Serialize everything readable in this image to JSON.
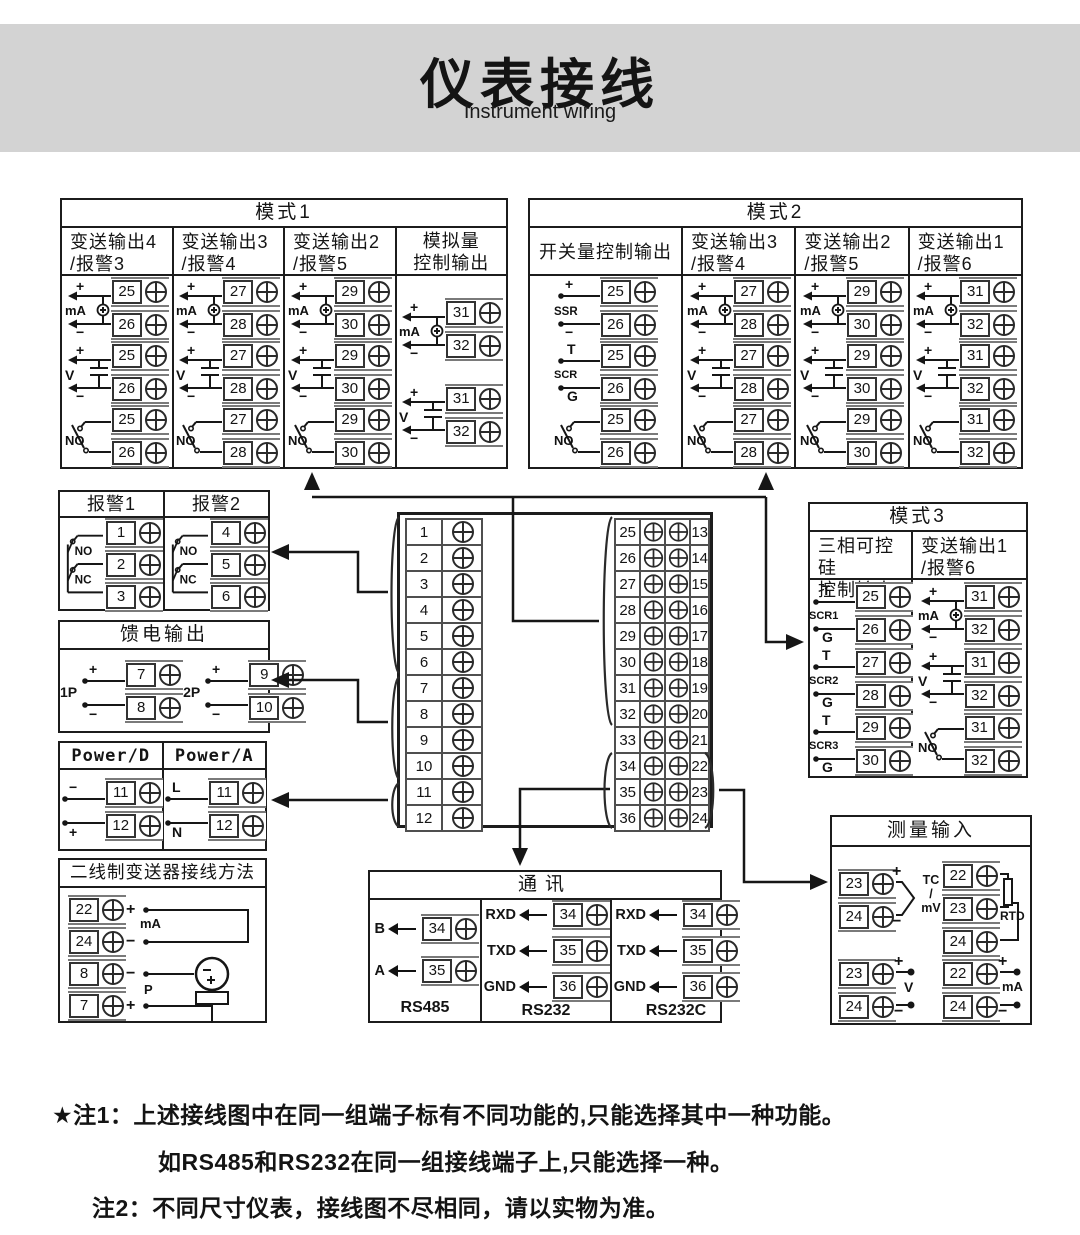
{
  "title": {
    "zh": "仪表接线",
    "en": "Instrument wiring"
  },
  "modes": {
    "mode1": {
      "title": "模式1",
      "columns": [
        {
          "header": "变送输出4\n/报警3",
          "diagrams": [
            {
              "type": "ma",
              "label": "mA",
              "top": "+",
              "bottom": "−",
              "terminals": [
                "25",
                "26"
              ]
            },
            {
              "type": "v",
              "label": "V",
              "top": "+",
              "bottom": "−",
              "terminals": [
                "25",
                "26"
              ]
            },
            {
              "type": "no",
              "label": "NO",
              "terminals": [
                "25",
                "26"
              ]
            }
          ]
        },
        {
          "header": "变送输出3\n/报警4",
          "diagrams": [
            {
              "type": "ma",
              "label": "mA",
              "top": "+",
              "bottom": "−",
              "terminals": [
                "27",
                "28"
              ]
            },
            {
              "type": "v",
              "label": "V",
              "top": "+",
              "bottom": "−",
              "terminals": [
                "27",
                "28"
              ]
            },
            {
              "type": "no",
              "label": "NO",
              "terminals": [
                "27",
                "28"
              ]
            }
          ]
        },
        {
          "header": "变送输出2\n/报警5",
          "diagrams": [
            {
              "type": "ma",
              "label": "mA",
              "top": "+",
              "bottom": "−",
              "terminals": [
                "29",
                "30"
              ]
            },
            {
              "type": "v",
              "label": "V",
              "top": "+",
              "bottom": "−",
              "terminals": [
                "29",
                "30"
              ]
            },
            {
              "type": "no",
              "label": "NO",
              "terminals": [
                "29",
                "30"
              ]
            }
          ]
        },
        {
          "header": "模拟量\n控制输出",
          "diagrams": [
            {
              "type": "ma",
              "label": "mA",
              "top": "+",
              "bottom": "−",
              "terminals": [
                "31",
                "32"
              ]
            },
            {
              "type": "v",
              "label": "V",
              "top": "+",
              "bottom": "−",
              "terminals": [
                "31",
                "32"
              ]
            }
          ]
        }
      ]
    },
    "mode2": {
      "title": "模式2",
      "columns": [
        {
          "header": "开关量控制输出",
          "diagrams": [
            {
              "type": "ssr",
              "label": "SSR",
              "top": "+",
              "bottom": "−",
              "terminals": [
                "25",
                "26"
              ]
            },
            {
              "type": "scr",
              "label": "SCR",
              "top": "T",
              "bottom": "G",
              "terminals": [
                "25",
                "26"
              ]
            },
            {
              "type": "no",
              "label": "NO",
              "terminals": [
                "25",
                "26"
              ]
            }
          ]
        },
        {
          "header": "变送输出3\n/报警4",
          "diagrams": [
            {
              "type": "ma",
              "label": "mA",
              "top": "+",
              "bottom": "−",
              "terminals": [
                "27",
                "28"
              ]
            },
            {
              "type": "v",
              "label": "V",
              "top": "+",
              "bottom": "−",
              "terminals": [
                "27",
                "28"
              ]
            },
            {
              "type": "no",
              "label": "NO",
              "terminals": [
                "27",
                "28"
              ]
            }
          ]
        },
        {
          "header": "变送输出2\n/报警5",
          "diagrams": [
            {
              "type": "ma",
              "label": "mA",
              "top": "+",
              "bottom": "−",
              "terminals": [
                "29",
                "30"
              ]
            },
            {
              "type": "v",
              "label": "V",
              "top": "+",
              "bottom": "−",
              "terminals": [
                "29",
                "30"
              ]
            },
            {
              "type": "no",
              "label": "NO",
              "terminals": [
                "29",
                "30"
              ]
            }
          ]
        },
        {
          "header": "变送输出1\n/报警6",
          "diagrams": [
            {
              "type": "ma",
              "label": "mA",
              "top": "+",
              "bottom": "−",
              "terminals": [
                "31",
                "32"
              ]
            },
            {
              "type": "v",
              "label": "V",
              "top": "+",
              "bottom": "−",
              "terminals": [
                "31",
                "32"
              ]
            },
            {
              "type": "no",
              "label": "NO",
              "terminals": [
                "31",
                "32"
              ]
            }
          ]
        }
      ]
    },
    "mode3": {
      "title": "模式3",
      "columns": [
        {
          "header": "三相可控硅\n控制输出",
          "diagrams": [
            {
              "type": "scr",
              "label": "SCR1",
              "top": "T",
              "bottom": "G",
              "terminals": [
                "25",
                "26"
              ]
            },
            {
              "type": "scr",
              "label": "SCR2",
              "top": "T",
              "bottom": "G",
              "terminals": [
                "27",
                "28"
              ]
            },
            {
              "type": "scr",
              "label": "SCR3",
              "top": "T",
              "bottom": "G",
              "terminals": [
                "29",
                "30"
              ]
            }
          ]
        },
        {
          "header": "变送输出1\n/报警6",
          "diagrams": [
            {
              "type": "ma",
              "label": "mA",
              "top": "+",
              "bottom": "−",
              "terminals": [
                "31",
                "32"
              ]
            },
            {
              "type": "v",
              "label": "V",
              "top": "+",
              "bottom": "−",
              "terminals": [
                "31",
                "32"
              ]
            },
            {
              "type": "no",
              "label": "NO",
              "terminals": [
                "31",
                "32"
              ]
            }
          ]
        }
      ]
    }
  },
  "alarm": {
    "columns": [
      {
        "header": "报警1",
        "no": "NO",
        "nc": "NC",
        "terminals": [
          "1",
          "2",
          "3"
        ]
      },
      {
        "header": "报警2",
        "no": "NO",
        "nc": "NC",
        "terminals": [
          "4",
          "5",
          "6"
        ]
      }
    ]
  },
  "feed": {
    "title": "馈电输出",
    "groups": [
      {
        "label": "1P",
        "top": "+",
        "bottom": "−",
        "terminals": [
          "7",
          "8"
        ]
      },
      {
        "label": "2P",
        "top": "+",
        "bottom": "−",
        "terminals": [
          "9",
          "10"
        ]
      }
    ]
  },
  "power": {
    "columns": [
      {
        "header": "Power/D",
        "top": "−",
        "bottom": "+",
        "terminals": [
          "11",
          "12"
        ]
      },
      {
        "header": "Power/A",
        "top": "L",
        "bottom": "N",
        "terminals": [
          "11",
          "12"
        ]
      }
    ]
  },
  "twowire": {
    "title": "二线制变送器接线方法",
    "ma_label": "mA",
    "p_label": "P",
    "rows": [
      {
        "terminal": "22",
        "sign": "+"
      },
      {
        "terminal": "24",
        "sign": "−"
      },
      {
        "terminal": "8",
        "sign": "−"
      },
      {
        "terminal": "7",
        "sign": "+"
      }
    ]
  },
  "center": {
    "left": [
      "1",
      "2",
      "3",
      "4",
      "5",
      "6",
      "7",
      "8",
      "9",
      "10",
      "11",
      "12"
    ],
    "rows": [
      [
        "25",
        "13"
      ],
      [
        "26",
        "14"
      ],
      [
        "27",
        "15"
      ],
      [
        "28",
        "16"
      ],
      [
        "29",
        "17"
      ],
      [
        "30",
        "18"
      ],
      [
        "31",
        "19"
      ],
      [
        "32",
        "20"
      ],
      [
        "33",
        "21"
      ],
      [
        "34",
        "22"
      ],
      [
        "35",
        "23"
      ],
      [
        "36",
        "24"
      ]
    ]
  },
  "comm": {
    "title": "通讯",
    "sections": [
      {
        "name": "RS485",
        "rows": [
          {
            "label": "B",
            "terminal": "34"
          },
          {
            "label": "A",
            "terminal": "35"
          }
        ]
      },
      {
        "name": "RS232",
        "rows": [
          {
            "label": "RXD",
            "terminal": "34"
          },
          {
            "label": "TXD",
            "terminal": "35"
          },
          {
            "label": "GND",
            "terminal": "36"
          }
        ]
      },
      {
        "name": "RS232C",
        "rows": [
          {
            "label": "RXD",
            "terminal": "34"
          },
          {
            "label": "TXD",
            "terminal": "35"
          },
          {
            "label": "GND",
            "terminal": "36"
          }
        ]
      }
    ]
  },
  "measure": {
    "title": "测量输入",
    "tc": {
      "label": "TC\n/\nmV",
      "rows": [
        {
          "terminal": "23",
          "sign": "+"
        },
        {
          "terminal": "24",
          "sign": "−"
        }
      ]
    },
    "rtd": {
      "label": "RTD",
      "terminals": [
        "22",
        "23",
        "24"
      ]
    },
    "volt": {
      "label": "V",
      "rows": [
        {
          "terminal": "23",
          "sign": "+"
        },
        {
          "terminal": "24",
          "sign": "−"
        }
      ]
    },
    "amp": {
      "label": "mA",
      "rows": [
        {
          "terminal": "22",
          "sign": "+"
        },
        {
          "terminal": "24",
          "sign": "−"
        }
      ]
    }
  },
  "notes": [
    {
      "text": "★注1：上述接线图中在同一组端子标有不同功能的,只能选择其中一种功能。"
    },
    {
      "text": "如RS485和RS232在同一组接线端子上,只能选择一种。"
    },
    {
      "text": "注2：不同尺寸仪表，接线图不尽相同，请以实物为准。"
    }
  ]
}
